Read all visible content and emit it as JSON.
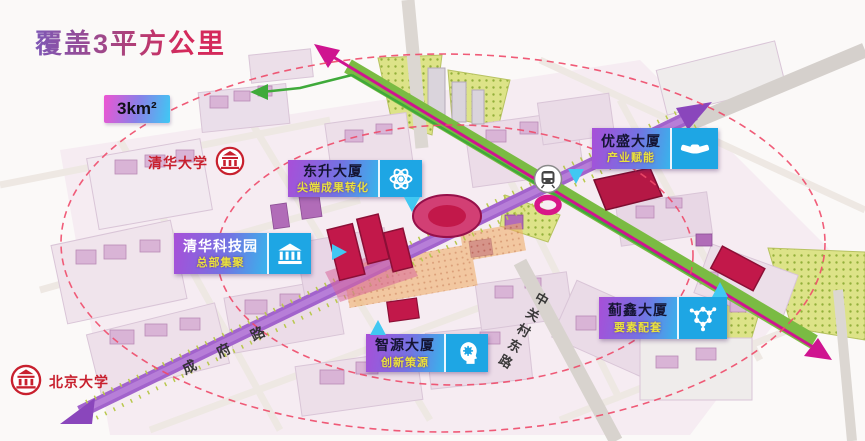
{
  "title": "覆盖3平方公里",
  "area_badge": "3km²",
  "universities": [
    {
      "name": "清华大学",
      "icon": "school-icon"
    },
    {
      "name": "北京大学",
      "icon": "school-icon"
    }
  ],
  "buildings": [
    {
      "name": "东升大厦",
      "tagline": "尖端成果转化",
      "icon": "atom-icon"
    },
    {
      "name": "清华科技园",
      "tagline": "总部集聚",
      "icon": "bank-icon"
    },
    {
      "name": "优盛大厦",
      "tagline": "产业赋能",
      "icon": "handshake-icon"
    },
    {
      "name": "蓟鑫大厦",
      "tagline": "要素配套",
      "icon": "molecule-icon"
    },
    {
      "name": "智源大厦",
      "tagline": "创新策源",
      "icon": "brain-icon"
    }
  ],
  "roads": [
    {
      "name": "成府路"
    },
    {
      "name": "中关村东路"
    }
  ],
  "map_icons": {
    "metro_station": "metro-station-icon"
  },
  "colors": {
    "title_gradient_start": "#7e57b5",
    "title_gradient_end": "#d4295b",
    "badge_gradient": [
      "#ee55d2",
      "#8a7fe8",
      "#3ec9f4"
    ],
    "label_gradient": [
      "#a84fd8",
      "#38b4ec"
    ],
    "label_tagline_yellow": "#e9e23e",
    "icon_tile_blue": "#1ea6e4",
    "highlight_building_red": "#c2184a",
    "road_purple": "#a263cc",
    "corridor_green": "#7abb43",
    "rail_magenta": "#cf1490",
    "boundary_dash_pink": "#ef4b6a",
    "university_red": "#c8202e"
  }
}
